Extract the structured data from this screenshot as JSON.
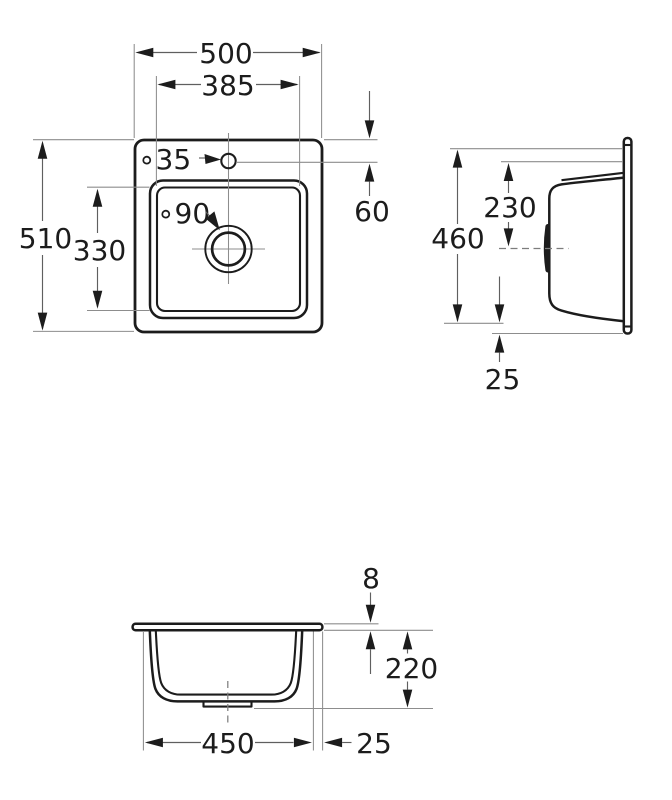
{
  "colors": {
    "background": "#ffffff",
    "ink": "#1c1c1c",
    "dimension_line": "#5f5f5f",
    "extension_line": "#8d8d8d",
    "centerline": "#7d7d7d"
  },
  "views": {
    "plan": {
      "labels": {
        "overall_width": "500",
        "bowl_width": "385",
        "overall_depth": "510",
        "bowl_depth": "330",
        "tap_hole_offset": "60",
        "tap_hole_diameter": "∘35",
        "drain_diameter": "∘90"
      }
    },
    "side": {
      "labels": {
        "cutout_depth": "460",
        "drain_center_offset": "230",
        "bottom_edge_offset": "25"
      }
    },
    "front": {
      "labels": {
        "rim_thickness": "8",
        "bowl_height": "220",
        "bowl_width": "450",
        "rim_overhang": "25"
      }
    }
  }
}
